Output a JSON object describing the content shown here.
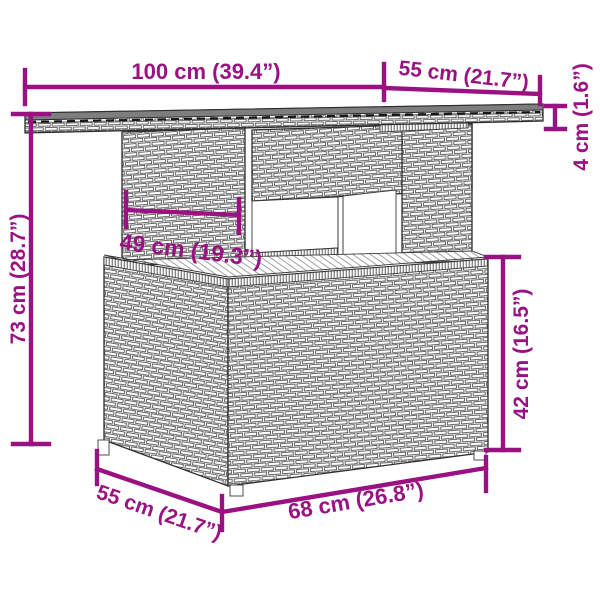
{
  "diagram": {
    "type": "product-dimension-diagram",
    "subject": "poly rattan garden table line-art with dimension annotations",
    "background": "#ffffff",
    "colors": {
      "dimension_annotation": "#9A1182",
      "line_art": "#2e2e2e",
      "tabletop_surface": "#7e7e7e"
    },
    "dimensions": {
      "top_width": {
        "label": "100 cm (39.4”)"
      },
      "top_depth": {
        "label": "55 cm (21.7”)"
      },
      "top_thickness": {
        "label": "4 cm (1.6”)"
      },
      "total_height": {
        "label": "73 cm (28.7”)"
      },
      "inner_width": {
        "label": "49 cm (19.3”)"
      },
      "base_height": {
        "label": "42 cm (16.5”)"
      },
      "base_depth": {
        "label": "55 cm (21.7”)"
      },
      "base_width": {
        "label": "68 cm (26.8”)"
      }
    }
  }
}
